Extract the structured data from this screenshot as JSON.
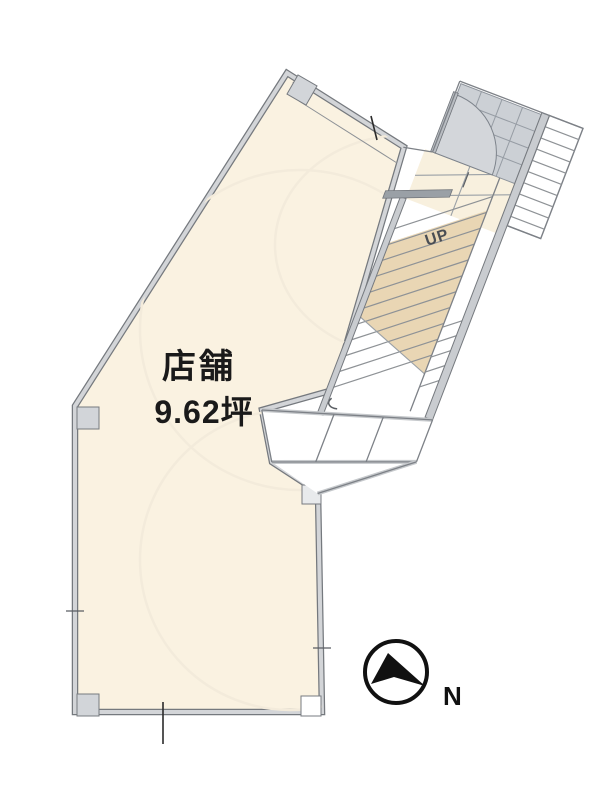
{
  "floor_plan": {
    "title": "store-floor-plan",
    "room": {
      "name": "店舗",
      "area": "9.62坪"
    },
    "stairs": {
      "label": "UP"
    },
    "compass": {
      "label": "N"
    }
  },
  "colors": {
    "room_fill": "#faf2e1",
    "stair_fill": "#e9d6b4",
    "landing_fill": "#f8f0de",
    "tile_fill": "#ccd0d5",
    "door_arc_fill": "#d3d6da",
    "door_leaf_fill": "#b9bdc2",
    "wall_light": "#cdd0d4",
    "wall_dark": "#75797e",
    "column_fill": "#d2d5d9",
    "column_fill_light": "#e8eaec",
    "column_fill_white": "#ffffff",
    "text_color": "#1a1a1a",
    "up_color": "#4a4e54",
    "compass_color": "#111111"
  }
}
